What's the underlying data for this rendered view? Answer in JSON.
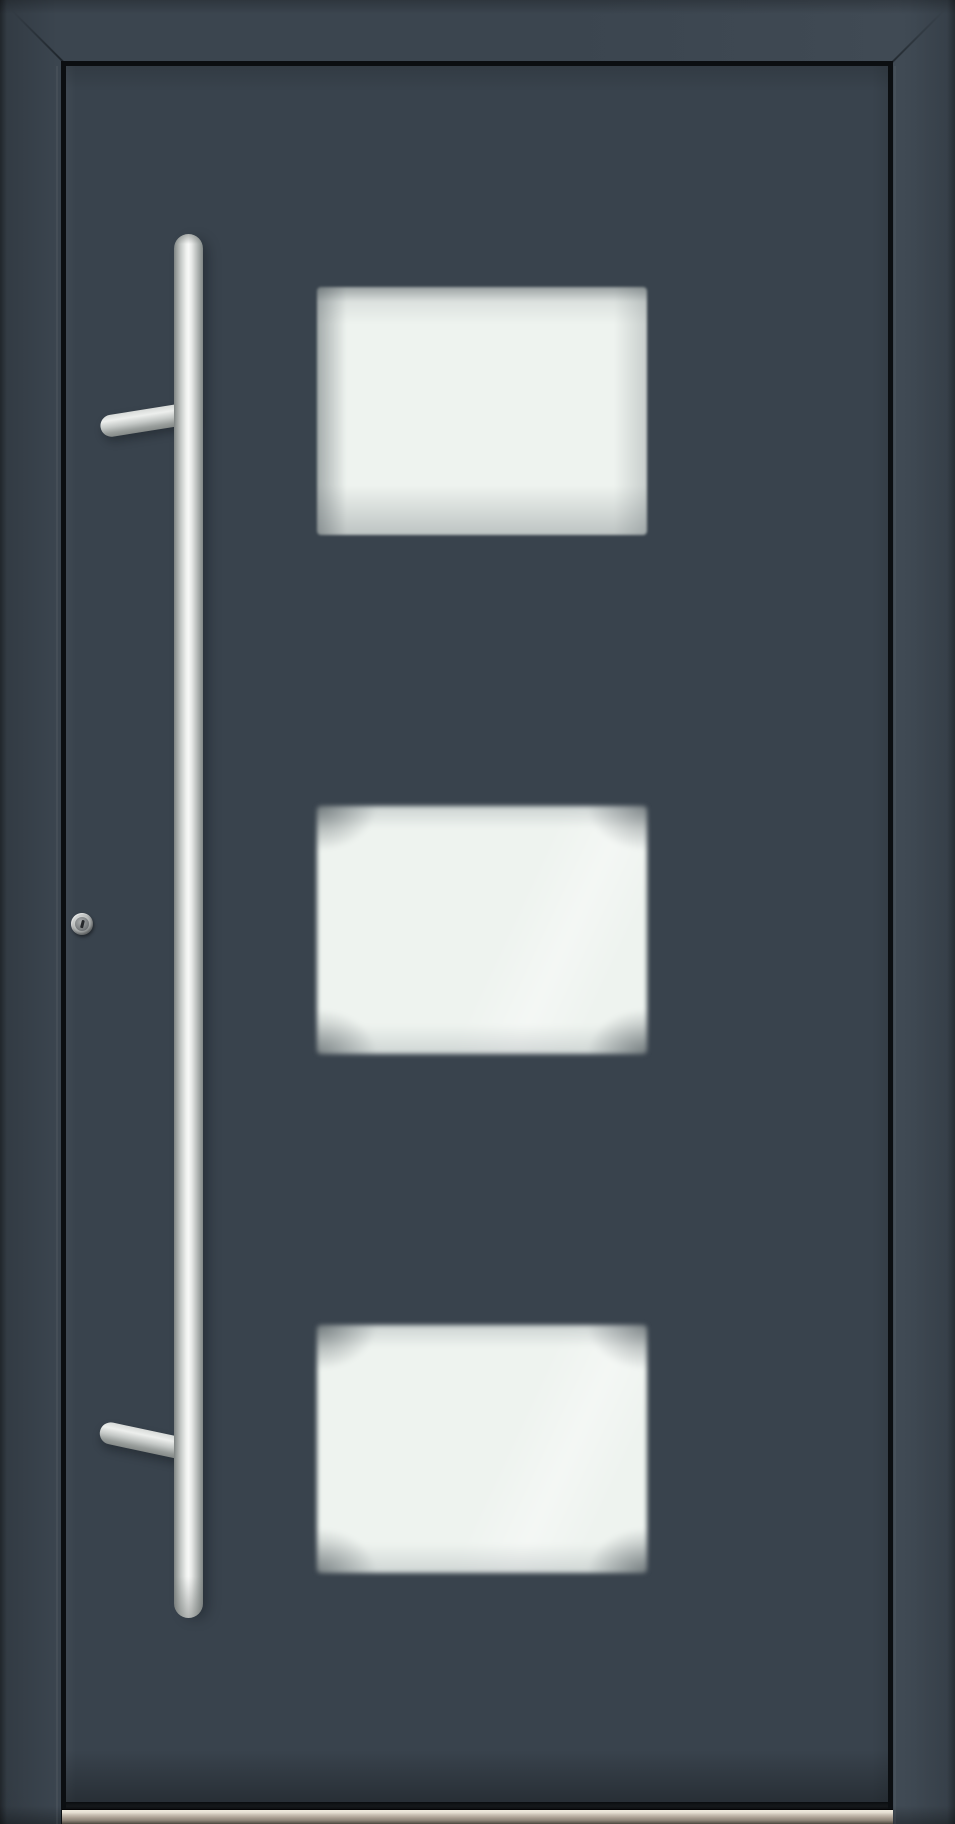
{
  "scene": {
    "subject": "Front view product photo of a modern aluminium entrance door",
    "door_finish": "matte anthracite grey",
    "visible_text": "none"
  },
  "frame": {
    "description": "anthracite outer frame with mitred top corners and dark shadow gap around the leaf"
  },
  "door_leaf": {
    "description": "flush anthracite door slab",
    "glass_panel_count": 3
  },
  "glass_panels": [
    {
      "position": "top",
      "finish": "frosted satin white glass, soft blurred edges"
    },
    {
      "position": "middle",
      "finish": "frosted satin white glass, vignetted corners"
    },
    {
      "position": "bottom",
      "finish": "frosted satin white glass, vignetted corners"
    }
  ],
  "handle": {
    "type": "vertical stainless-steel pull bar",
    "caps": "rounded top and bottom caps",
    "mounts": [
      {
        "position": "upper",
        "style": "round stand-off arm angled slightly upward"
      },
      {
        "position": "lower",
        "style": "round stand-off arm angled slightly downward"
      }
    ]
  },
  "lock": {
    "type": "round stainless profile cylinder with keyhole",
    "location": "left edge of leaf at mid-height"
  },
  "threshold": {
    "description": "brushed aluminium bottom threshold strip with bright top highlight"
  },
  "colors": {
    "edge": "#242b31",
    "frame": "#3b454f",
    "frame-hi": "#404a54",
    "door": "#39434d",
    "gap": "#0b0e11",
    "glass-light": "#eef3ef",
    "glass-mid": "#e4ebe7",
    "glass-shade": "#c6cfcc",
    "steel-bright": "#f8f9f8",
    "steel-mid": "#c6cac8",
    "steel-dark": "#7e8483",
    "thresh-light": "#e6dfd3",
    "thresh-mid": "#ab9f93",
    "thresh-dark": "#4c473f"
  }
}
